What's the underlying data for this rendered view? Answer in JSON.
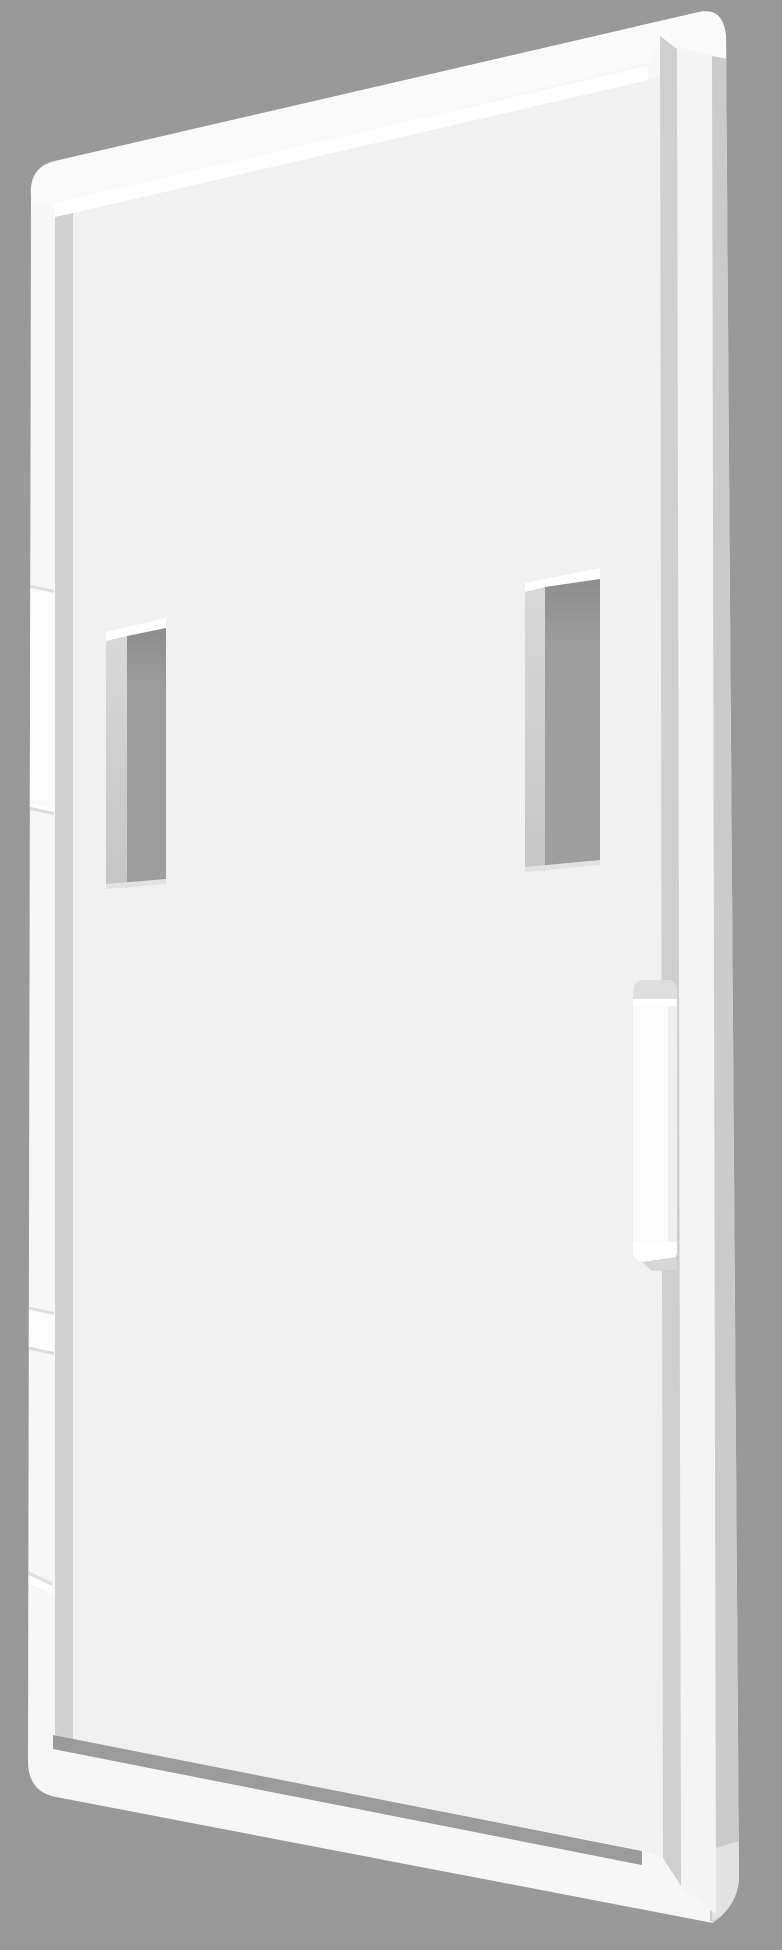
{
  "scene": {
    "object": "white rectangular mounting plate rendered in 3D perspective",
    "features": "two vertical through-slots in upper half, snap tab on right edge, small tab steps on left edge",
    "slot_count": 2,
    "background_color": "#999999"
  },
  "colors": {
    "background": "#999999",
    "plate_base": "#f7f7f7",
    "face": "#f1f1f1",
    "top_band": "#fafafa",
    "highlight": "#ffffff",
    "groove_left": "#d2d2d2",
    "groove_right": "#cfcfcf",
    "groove_bottom": "#9b9b9b",
    "side_face": "#cbcbcb",
    "corner_light": "#e2e2e2",
    "rim_right": "#f4f4f4",
    "slot_cap": "#ffffff",
    "slot_hole_top": "#8d8d8d",
    "slot_hole_bottom": "#9e9e9e",
    "slot_face_top": "#d8d8d8",
    "slot_face_bottom": "#c6c6c6",
    "slot_bottom_edge": "#e2e2e2",
    "tab_body": "#fbfbfb",
    "tab_bevel": "#dedede",
    "tab_inner_shade": "#f0f0f0",
    "tab_cap": "#ffffff",
    "tab_shadow": "#d6d6d6",
    "detail_shadow": "#dcdcdc",
    "detail_line": "#e0e0e0",
    "detail_highlight": "#ffffff"
  }
}
